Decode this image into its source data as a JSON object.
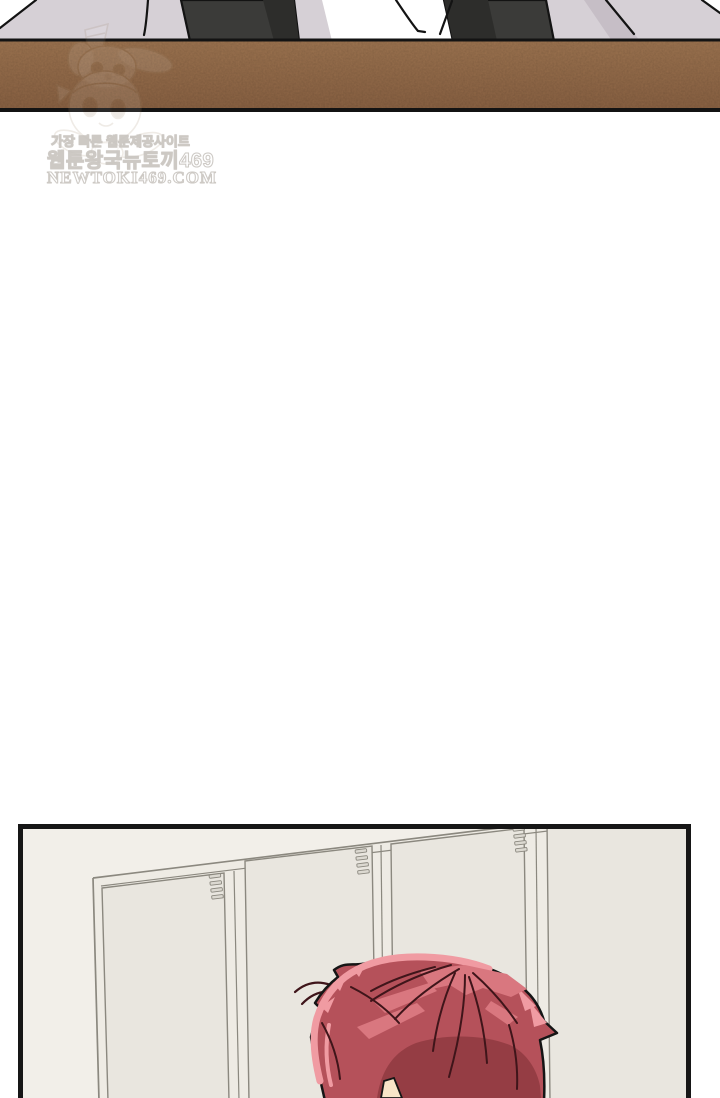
{
  "page": {
    "kind": "webtoon episode scan",
    "background": "#ffffff",
    "panel_count_visible": 2
  },
  "watermark": {
    "tagline": "가장 빠른 웹툰제공사이트",
    "site_name": "웹툰왕국뉴토끼469",
    "domain": "NEWTOKI469.COM",
    "mascot": "faint rabbit-plush chibi girl mascot"
  },
  "panels": [
    {
      "id": "top",
      "scene": "bottom slice of a classroom panel: dark desk legs on a pale lavender floor above a brown wooden strip"
    },
    {
      "id": "bottom",
      "scene": "locker room: row of cream lockers with vent grilles, red-haired character seen from behind, panel cut off at page bottom"
    }
  ],
  "colors": {
    "floor-lavender": "#d6d0d6",
    "floor-shadow": "#c6bec6",
    "leg-dark": "#3b3b39",
    "leg-darker": "#2d2d2b",
    "wood-brown": "#9d7450",
    "wood-brown-dark": "#8a6243",
    "ink": "#131313",
    "wall": "#f2efe9",
    "locker-frame": "#eeebe4",
    "locker-door": "#e9e6df",
    "locker-line": "#8b887f",
    "vent-fill": "#dcd9d1",
    "hair-base": "#b5515a",
    "hair-highlight": "#d9777f",
    "hair-rim": "#f09ba2",
    "hair-shadow": "#953d44",
    "hair-line": "#3f151a",
    "skin": "#f8e5c8",
    "panel-border": "#161616"
  }
}
